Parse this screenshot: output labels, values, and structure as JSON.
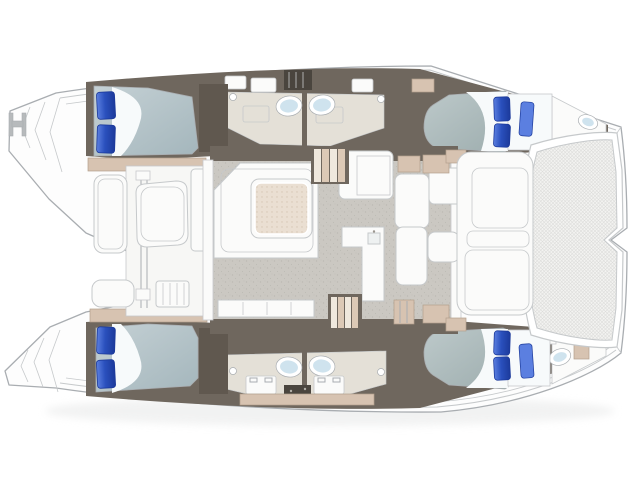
{
  "plan": {
    "drawing": "catamaran-deck-floor-plan",
    "orientation": {
      "bow": "right",
      "stern": "left"
    },
    "areas": [
      "stern-platforms",
      "aft-deck-cockpit",
      "port-aft-cabin",
      "port-heads",
      "saloon",
      "galley",
      "starboard-aft-cabin",
      "starboard-heads",
      "port-forward-cabin",
      "starboard-forward-cabin",
      "forward-cockpit",
      "bow-trampoline"
    ],
    "fixtures": {
      "double_beds": 4,
      "pillows": 10,
      "sinks": 4,
      "toilets": 2,
      "tables": 2,
      "companionway_stairs": 2,
      "cockpit_benches": 2,
      "trampolines": 1
    }
  },
  "colors": {
    "hull_fill": "#fdfdfd",
    "hull_line": "#a9adb1",
    "line_soft": "#c6c9cb",
    "interior_dark": "#6f675e",
    "interior_darker": "#4a453e",
    "wardrobe": "#60584f",
    "tan": "#d7c3b1",
    "tan_line": "#b3a08c",
    "vanity_cream": "#e4e0d7",
    "floor_gray": "#cbc8c2",
    "floor_speck": "#b2afa8",
    "white_furniture": "#fbfbfa",
    "cockpit_floor": "#f7f7f5",
    "sheet_white": "#f7fafb",
    "duvet_light": "#c5d1d5",
    "duvet_dark": "#a4b6bc",
    "duvet_fore_light": "#bdc9ca",
    "duvet_fore_dark": "#9dadae",
    "pillow_blue": "#2a50bd",
    "pillow_blue_dark": "#1c3a9b",
    "pillow_blue_light": "#5b7fe0",
    "sink_blue": "#cfe3ee",
    "mesh_base": "#f3f3f1",
    "mesh_line": "#dcdcda",
    "table_top": "#eadfd2",
    "table_dot": "#d6c6b4",
    "tread_light": "#efe8dd",
    "tread_dark": "#dcc9b6",
    "shadow": "#e7e8e8"
  }
}
